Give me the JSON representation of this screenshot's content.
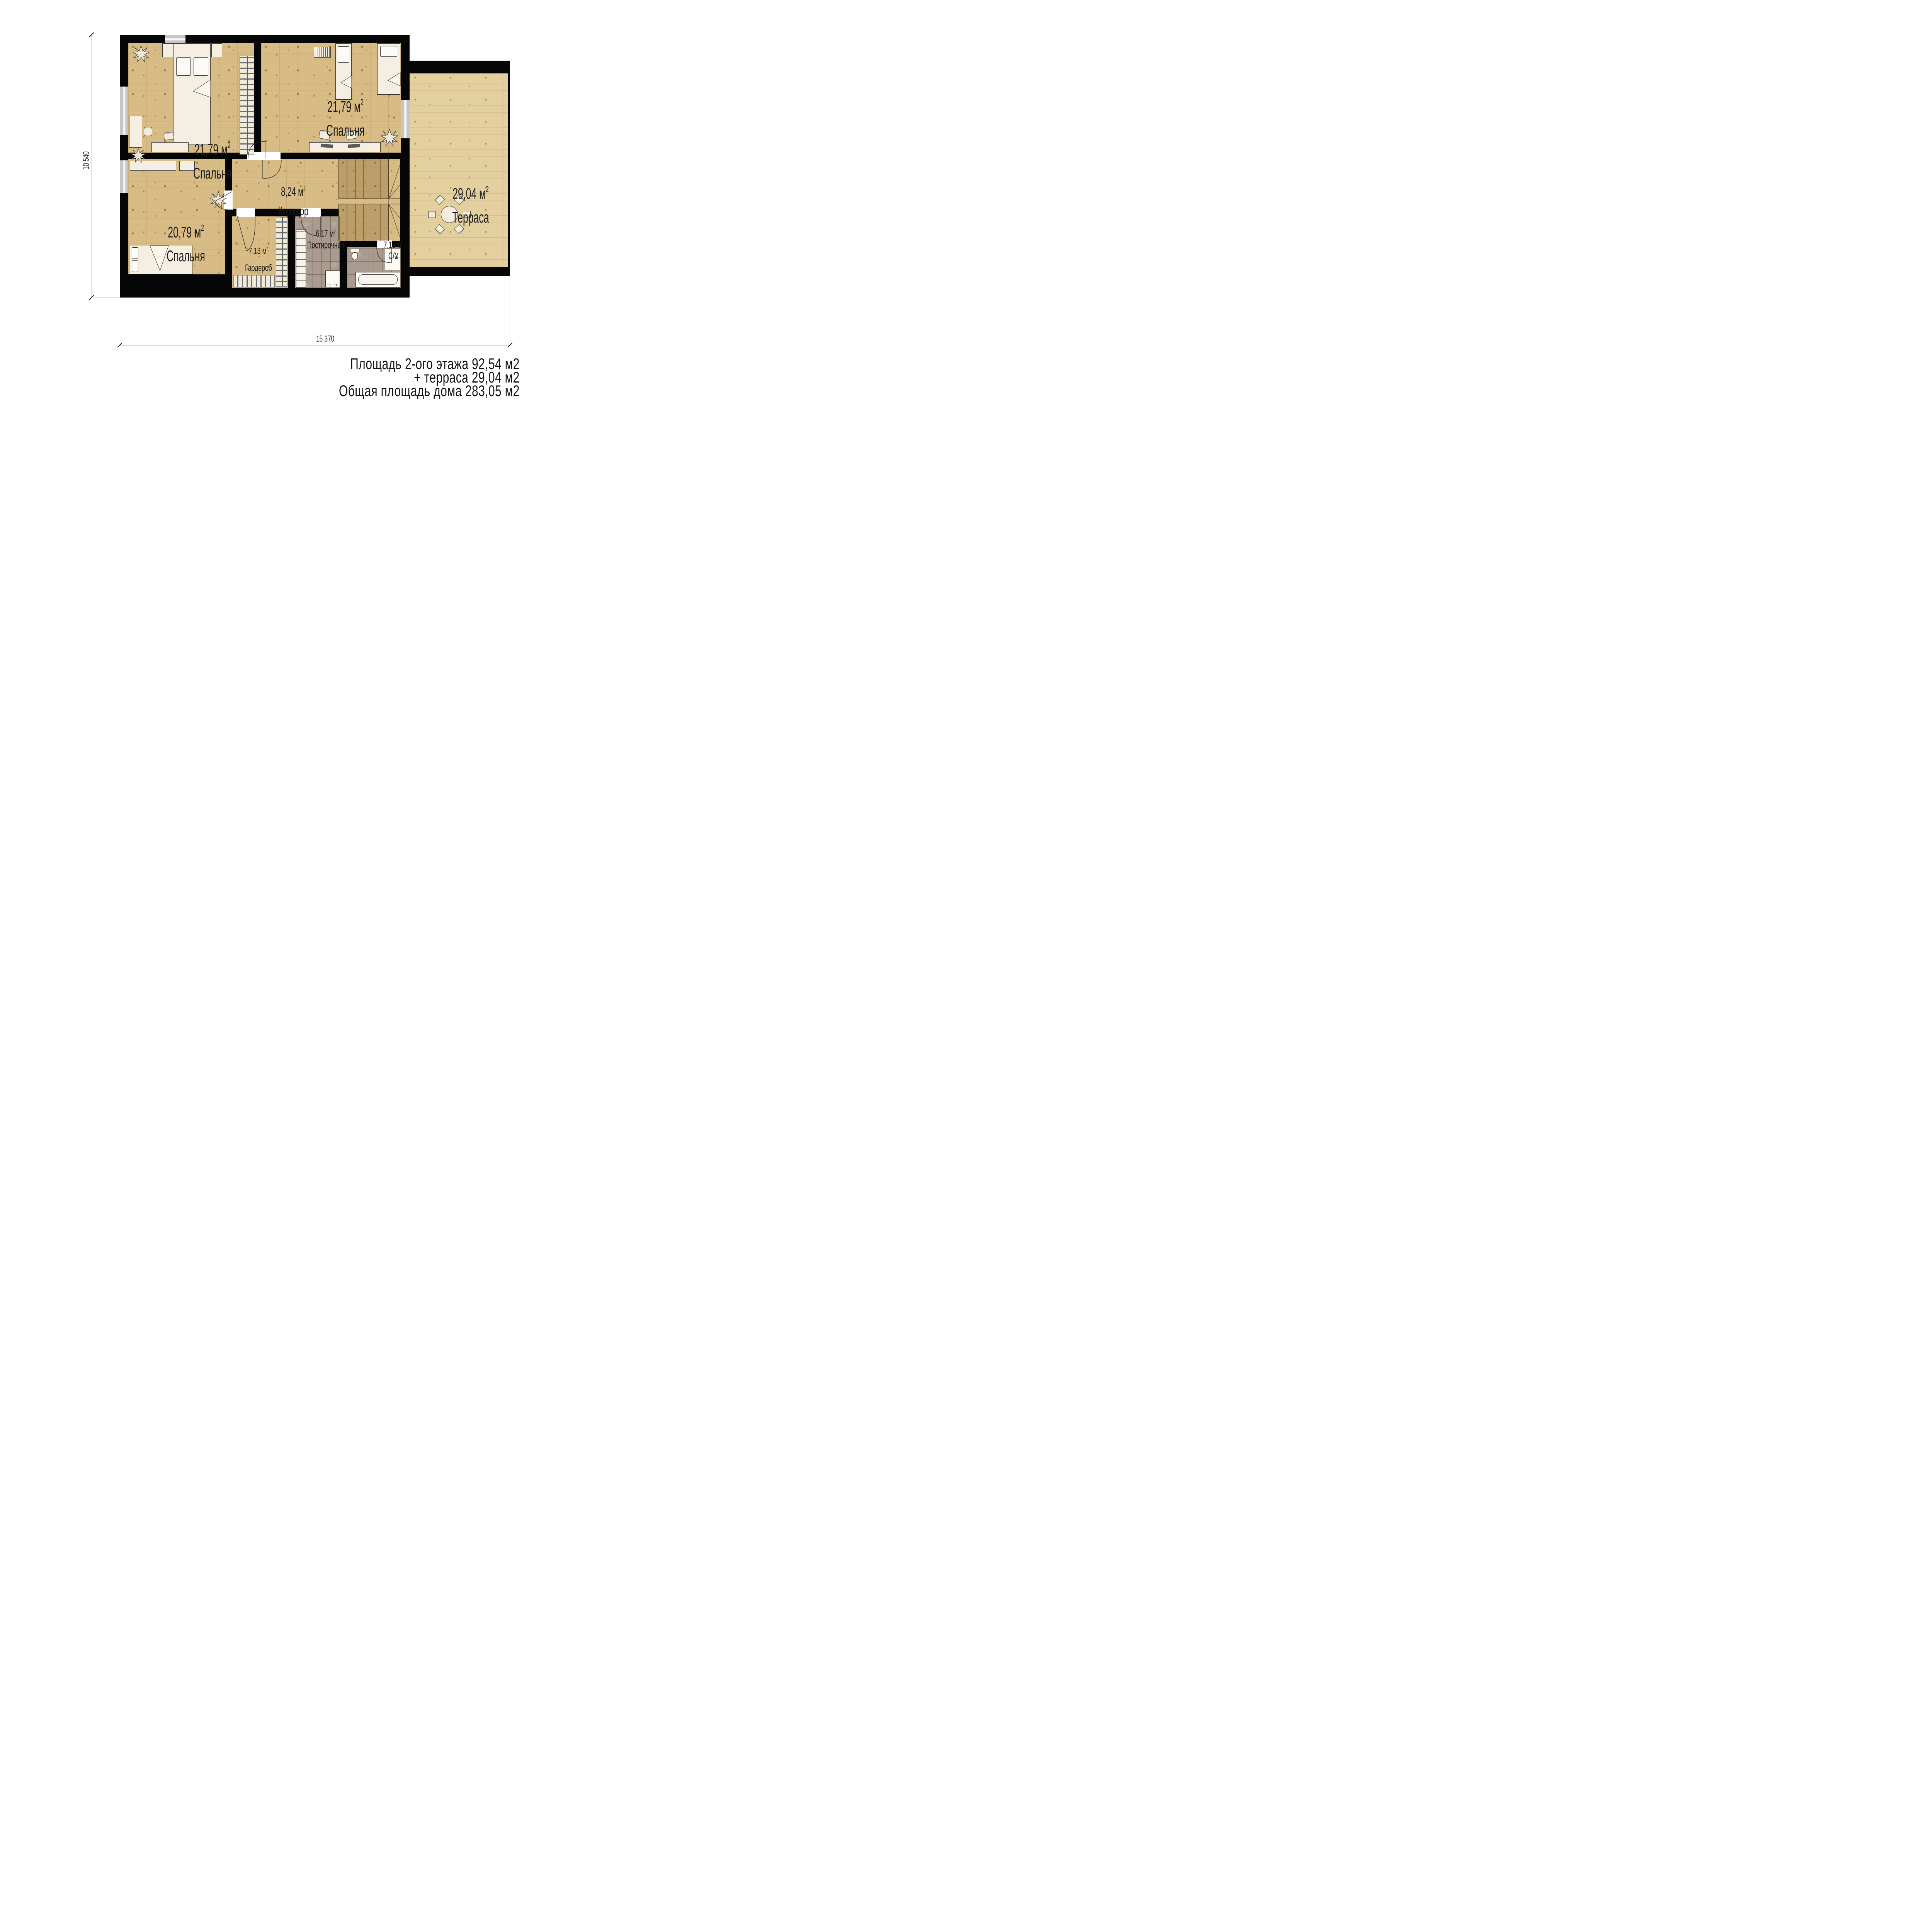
{
  "rooms": [
    {
      "area_value": "21,79 м",
      "area_sup": "2",
      "name": "Спальня"
    },
    {
      "area_value": "21,79 м",
      "area_sup": "2",
      "name": "Спальня"
    },
    {
      "area_value": "29,04 м",
      "area_sup": "2",
      "name": "Терраса"
    },
    {
      "area_value": "8,24 м",
      "area_sup": "2",
      "name": "Коридор"
    },
    {
      "area_value": "20,79 м",
      "area_sup": "2",
      "name": "Спальня"
    },
    {
      "area_value": "7,13 м",
      "area_sup": "2",
      "name": "Гардероб"
    },
    {
      "area_value": "6,17 м",
      "area_sup": "2",
      "name": "Постирочная"
    },
    {
      "area_value": "7,13 м",
      "area_sup": "2",
      "name": "С/У"
    }
  ],
  "dimensions": {
    "height": "10 540",
    "width": "15 370"
  },
  "summary": {
    "line1": "Площадь 2-ого этажа 92,54 м2",
    "line2": "+ терраса 29,04 м2",
    "line3": "Общая площадь дома 283,05 м2"
  },
  "colors": {
    "wall": "#060606",
    "wood_floor": "#d8bc85",
    "terrace_floor": "#e4cf9f",
    "tile_floor": "#a99b8e",
    "furniture": "#f4efe2",
    "text": "#1b1b1b"
  }
}
